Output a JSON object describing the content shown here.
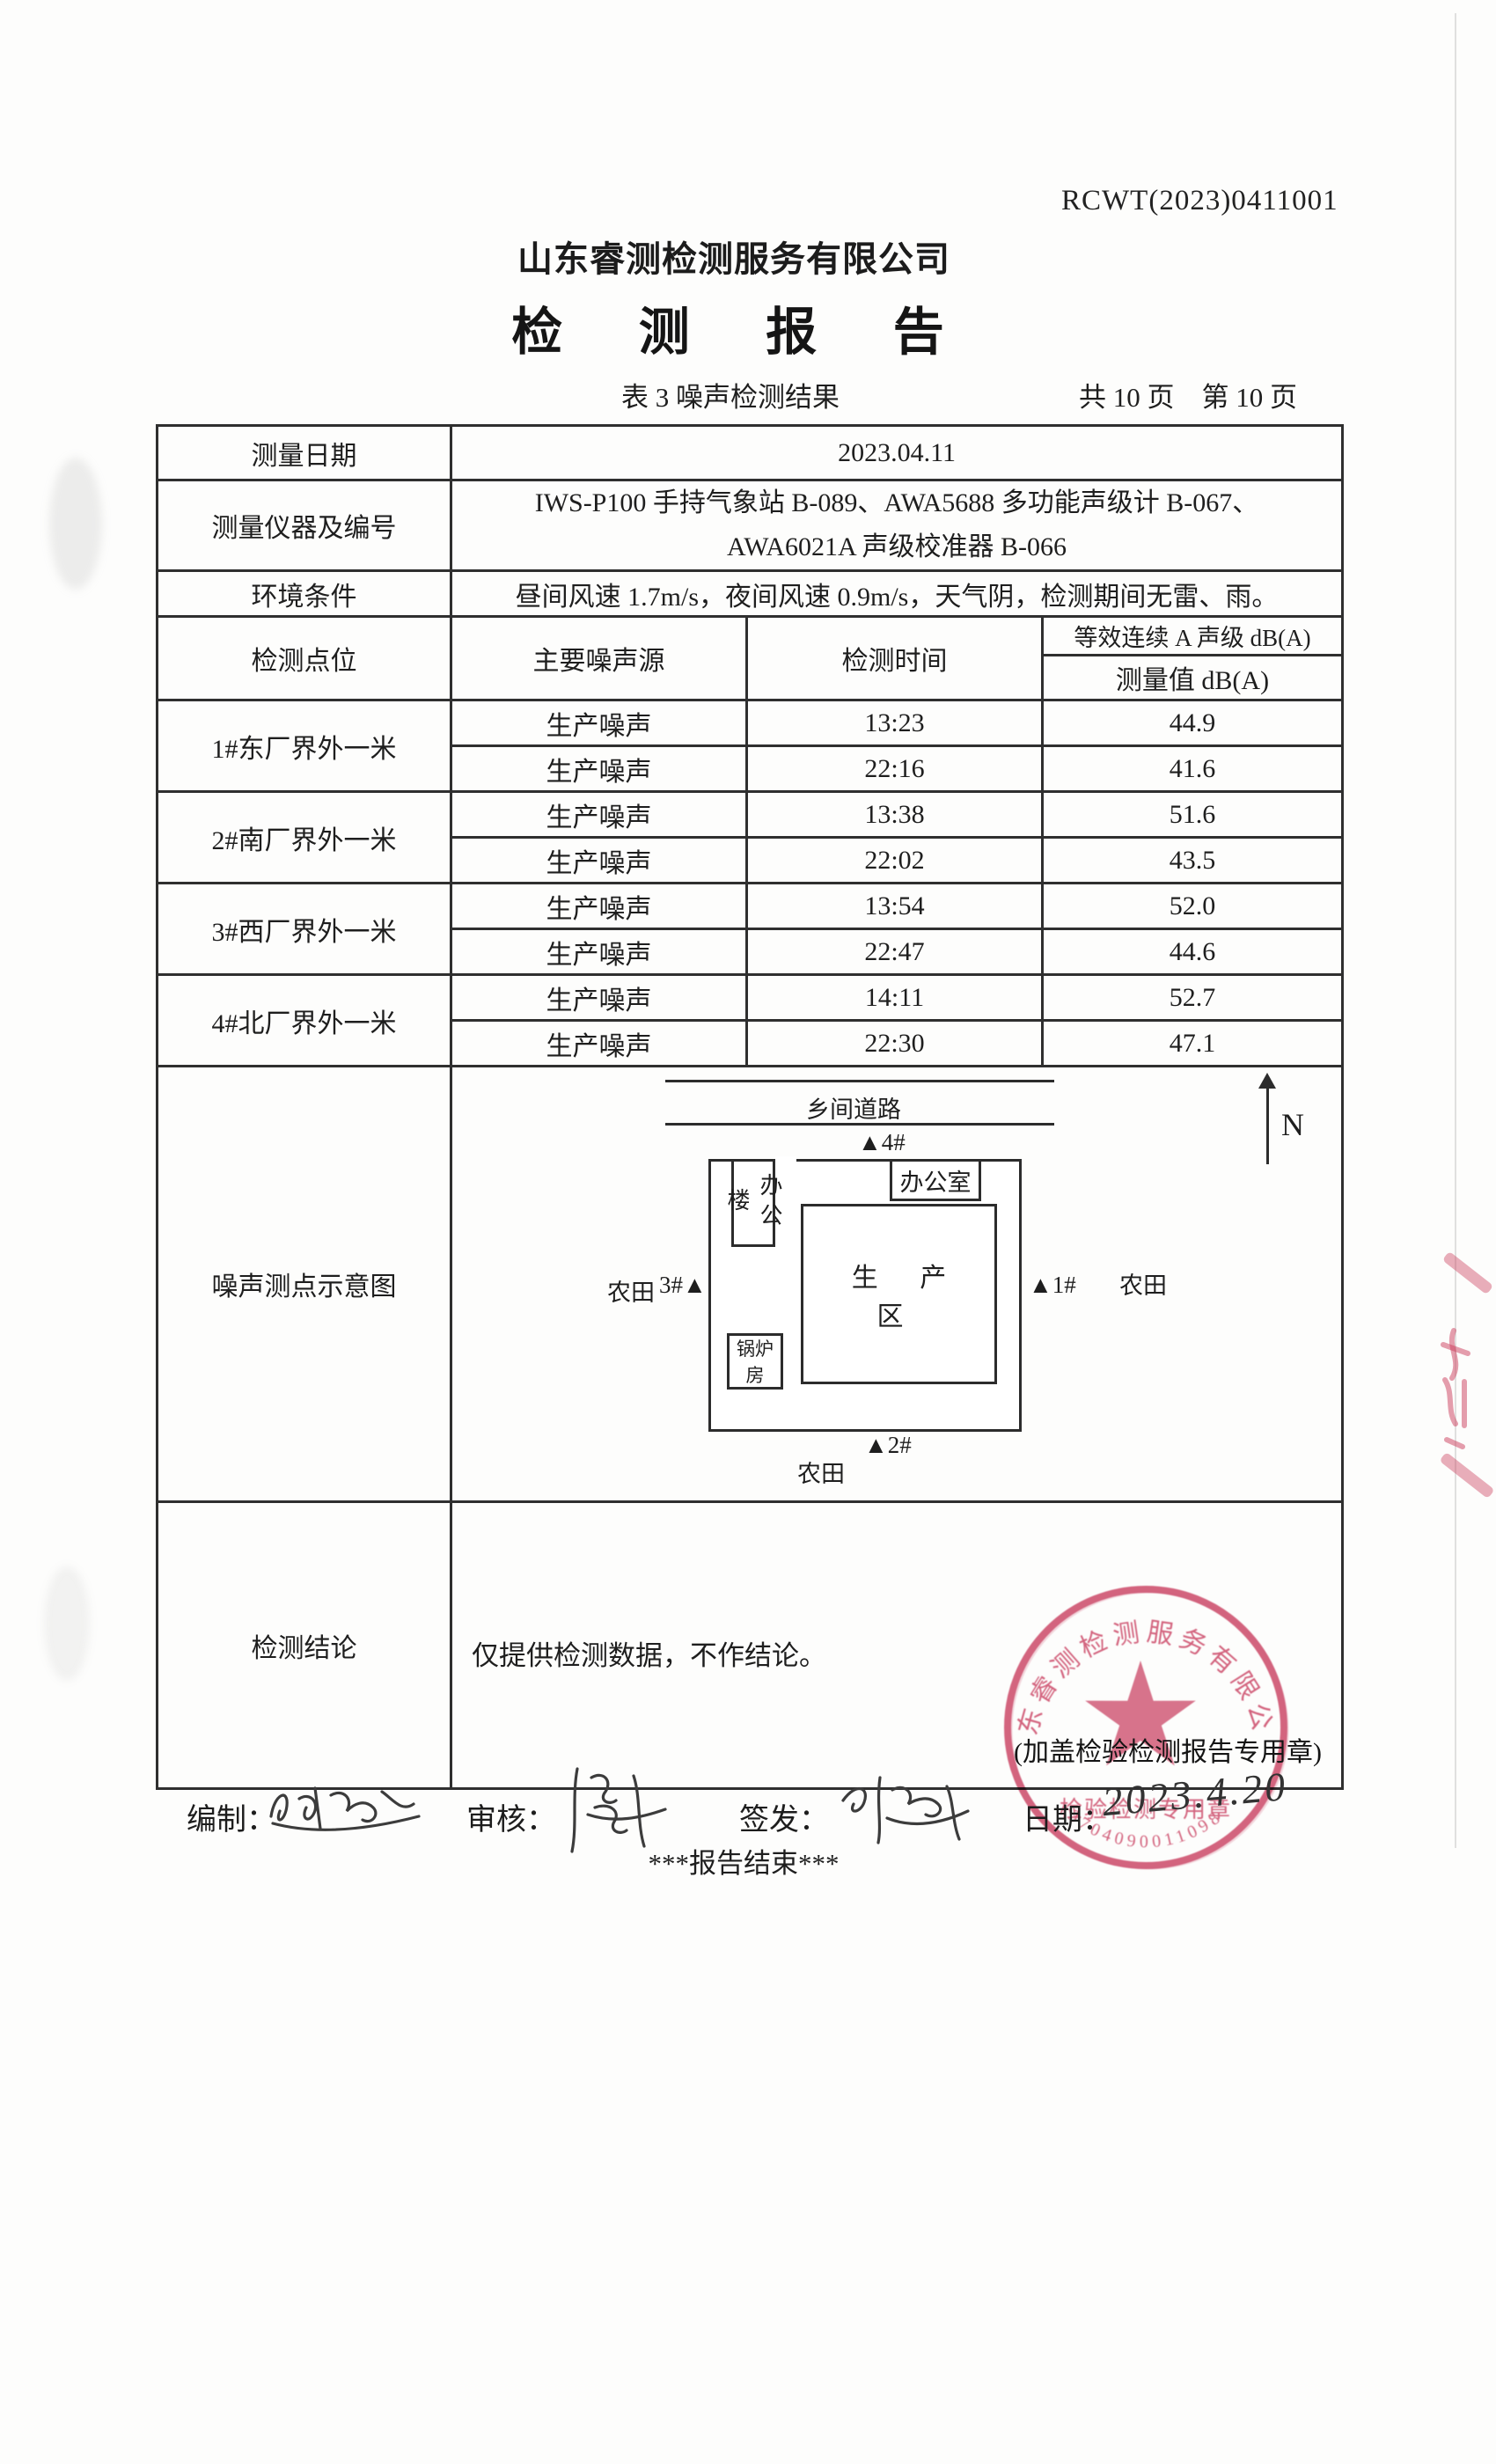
{
  "page": {
    "report_no": "RCWT(2023)0411001",
    "company": "山东睿测检测服务有限公司",
    "title": "检 测 报 告",
    "caption": "表 3  噪声检测结果",
    "pagination": "共 10 页　第 10 页"
  },
  "info": {
    "date_label": "测量日期",
    "date_value": "2023.04.11",
    "instrument_label": "测量仪器及编号",
    "instrument_line1": "IWS-P100 手持气象站 B-089、AWA5688 多功能声级计 B-067、",
    "instrument_line2": "AWA6021A 声级校准器 B-066",
    "env_label": "环境条件",
    "env_value": "昼间风速 1.7m/s，夜间风速 0.9m/s，天气阴，检测期间无雷、雨。"
  },
  "table": {
    "col_point": "检测点位",
    "col_source": "主要噪声源",
    "col_time": "检测时间",
    "col_leq": "等效连续 A 声级 dB(A)",
    "col_value": "测量值 dB(A)",
    "groups": [
      {
        "site": "1#东厂界外一米",
        "rows": [
          {
            "source": "生产噪声",
            "time": "13:23",
            "value": "44.9"
          },
          {
            "source": "生产噪声",
            "time": "22:16",
            "value": "41.6"
          }
        ]
      },
      {
        "site": "2#南厂界外一米",
        "rows": [
          {
            "source": "生产噪声",
            "time": "13:38",
            "value": "51.6"
          },
          {
            "source": "生产噪声",
            "time": "22:02",
            "value": "43.5"
          }
        ]
      },
      {
        "site": "3#西厂界外一米",
        "rows": [
          {
            "source": "生产噪声",
            "time": "13:54",
            "value": "52.0"
          },
          {
            "source": "生产噪声",
            "time": "22:47",
            "value": "44.6"
          }
        ]
      },
      {
        "site": "4#北厂界外一米",
        "rows": [
          {
            "source": "生产噪声",
            "time": "14:11",
            "value": "52.7"
          },
          {
            "source": "生产噪声",
            "time": "22:30",
            "value": "47.1"
          }
        ]
      }
    ]
  },
  "diagram": {
    "row_label": "噪声测点示意图",
    "road": "乡间道路",
    "north": "N",
    "point1": "▲1#",
    "point2": "▲2#",
    "point3": "3#▲",
    "point4": "▲4#",
    "office_building": "办公楼",
    "office": "办公室",
    "boiler_room": "锅炉房",
    "production_area": "生 产 区",
    "farmland": "农田"
  },
  "conclusion": {
    "label": "检测结论",
    "text": "仅提供检测数据，不作结论。",
    "stamp_note": "(加盖检验检测报告专用章)"
  },
  "stamp": {
    "ring_text": "山东睿测检测服务有限公司",
    "inner_text": "检验检测专用章",
    "serial": "3704090011098",
    "color": "#c9395c"
  },
  "footer": {
    "prepared_label": "编制：",
    "reviewed_label": "审核：",
    "issued_label": "签发：",
    "date_label": "日期：",
    "date_value": "2023.4.20",
    "end_text": "***报告结束***"
  }
}
